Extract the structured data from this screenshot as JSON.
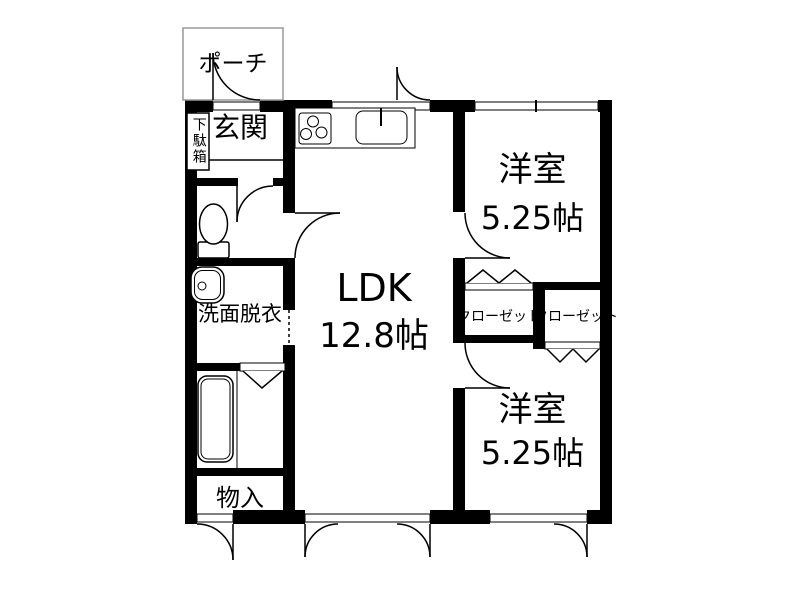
{
  "labels": {
    "porch": "ポーチ",
    "genkan": "玄関",
    "shoe_cabinet": "下駄箱",
    "washroom": "洗面脱衣",
    "storage": "物入",
    "ldk_name": "LDK",
    "ldk_size": "12.8帖",
    "bedroom1_name": "洋室",
    "bedroom1_size": "5.25帖",
    "bedroom2_name": "洋室",
    "bedroom2_size": "5.25帖",
    "closet_left": "クローゼット",
    "closet_right": "クローゼット"
  },
  "colors": {
    "wall": "#000000",
    "line": "#000000",
    "porch_outline": "#999999",
    "background": "#ffffff"
  }
}
